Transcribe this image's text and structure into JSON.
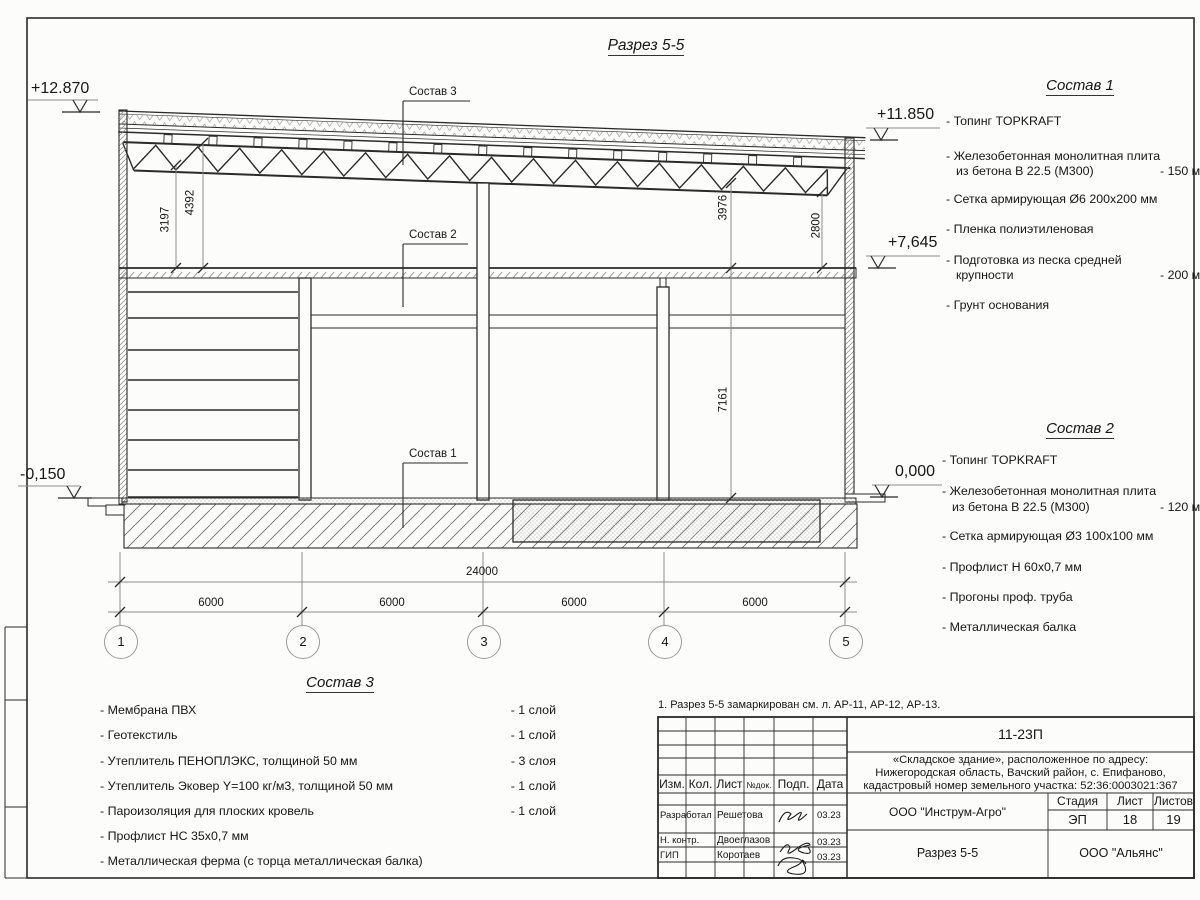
{
  "sheet": {
    "title": "Разрез 5-5",
    "note": "1. Разрез 5-5 замаркирован см. л. АР-11, АР-12, АР-13."
  },
  "elevations": {
    "top_left": "+12.870",
    "top_right": "+11.850",
    "mid_right": "+7,645",
    "zero_right": "0,000",
    "zero_left": "-0,150"
  },
  "leaders": {
    "sostav3": "Состав 3",
    "sostav2": "Состав 2",
    "sostav1": "Состав 1"
  },
  "dims": {
    "v3197": "3197",
    "v4392": "4392",
    "v3976": "3976",
    "v2800": "2800",
    "v7161": "7161",
    "total": "24000",
    "bays": [
      "6000",
      "6000",
      "6000",
      "6000"
    ]
  },
  "axes": [
    "1",
    "2",
    "3",
    "4",
    "5"
  ],
  "lists": {
    "s1": {
      "title": "Состав 1",
      "items": [
        {
          "t": "- Топинг TOPKRAFT",
          "v": ""
        },
        {
          "t": "- Железобетонная  монолитная плита",
          "v": ""
        },
        {
          "t": "из бетона  В 22.5 (М300)",
          "v": "- 150 мм"
        },
        {
          "t": "- Сетка армирующая Ø6 200x200 мм",
          "v": ""
        },
        {
          "t": "- Пленка полиэтиленовая",
          "v": ""
        },
        {
          "t": "- Подготовка из песка средней",
          "v": ""
        },
        {
          "t": "крупности",
          "v": "- 200 мм"
        },
        {
          "t": "- Грунт основания",
          "v": ""
        }
      ]
    },
    "s2": {
      "title": "Состав 2",
      "items": [
        {
          "t": "- Топинг TOPKRAFT",
          "v": ""
        },
        {
          "t": "- Железобетонная  монолитная плита",
          "v": ""
        },
        {
          "t": "из бетона  В 22.5 (М300)",
          "v": "- 120 мм"
        },
        {
          "t": "- Сетка армирующая Ø3 100x100 мм",
          "v": ""
        },
        {
          "t": "- Профлист Н 60x0,7 мм",
          "v": ""
        },
        {
          "t": "- Прогоны проф. труба",
          "v": ""
        },
        {
          "t": "- Металлическая балка",
          "v": ""
        }
      ]
    },
    "s3": {
      "title": "Состав 3",
      "items": [
        {
          "t": "- Мембрана ПВХ",
          "v": "- 1 слой"
        },
        {
          "t": "- Геотекстиль",
          "v": "- 1 слой"
        },
        {
          "t": "- Утеплитель ПЕНОПЛЭКС, толщиной 50 мм",
          "v": "- 3 слоя"
        },
        {
          "t": "- Утеплитель Эковер Y=100 кг/м3, толщиной 50 мм",
          "v": "- 1 слой"
        },
        {
          "t": "- Пароизоляция для плоских кровель",
          "v": "- 1 слой"
        },
        {
          "t": "- Профлист НС 35x0,7 мм",
          "v": ""
        },
        {
          "t": "- Металлическая ферма (с торца металлическая балка)",
          "v": ""
        }
      ]
    }
  },
  "titleblock": {
    "doc_number": "11-23П",
    "project_line1": "«Складское здание», расположенное по адресу:",
    "project_line2": "Нижегородская область, Вачский район, с. Епифаново,",
    "project_line3": "кадастровый номер земельного участка: 52:36:0003021:367",
    "org": "ООО \"Инструм-Агро\"",
    "sheet_title": "Разрез 5-5",
    "company": "ООО \"Альянс\"",
    "cols": [
      "Изм.",
      "Кол.",
      "Лист",
      "№док.",
      "Подп.",
      "Дата"
    ],
    "stage_label": "Стадия",
    "sheet_label": "Лист",
    "sheets_label": "Листов",
    "stage": "ЭП",
    "sheet_no": "18",
    "sheets_total": "19",
    "rows": [
      {
        "role": "Разработал",
        "name": "Решетова",
        "date": "03.23"
      },
      {
        "role": "Н. контр.",
        "name": "Двоеглазов",
        "date": "03.23"
      },
      {
        "role": "ГИП",
        "name": "Коротаев",
        "date": "03.23"
      }
    ]
  }
}
